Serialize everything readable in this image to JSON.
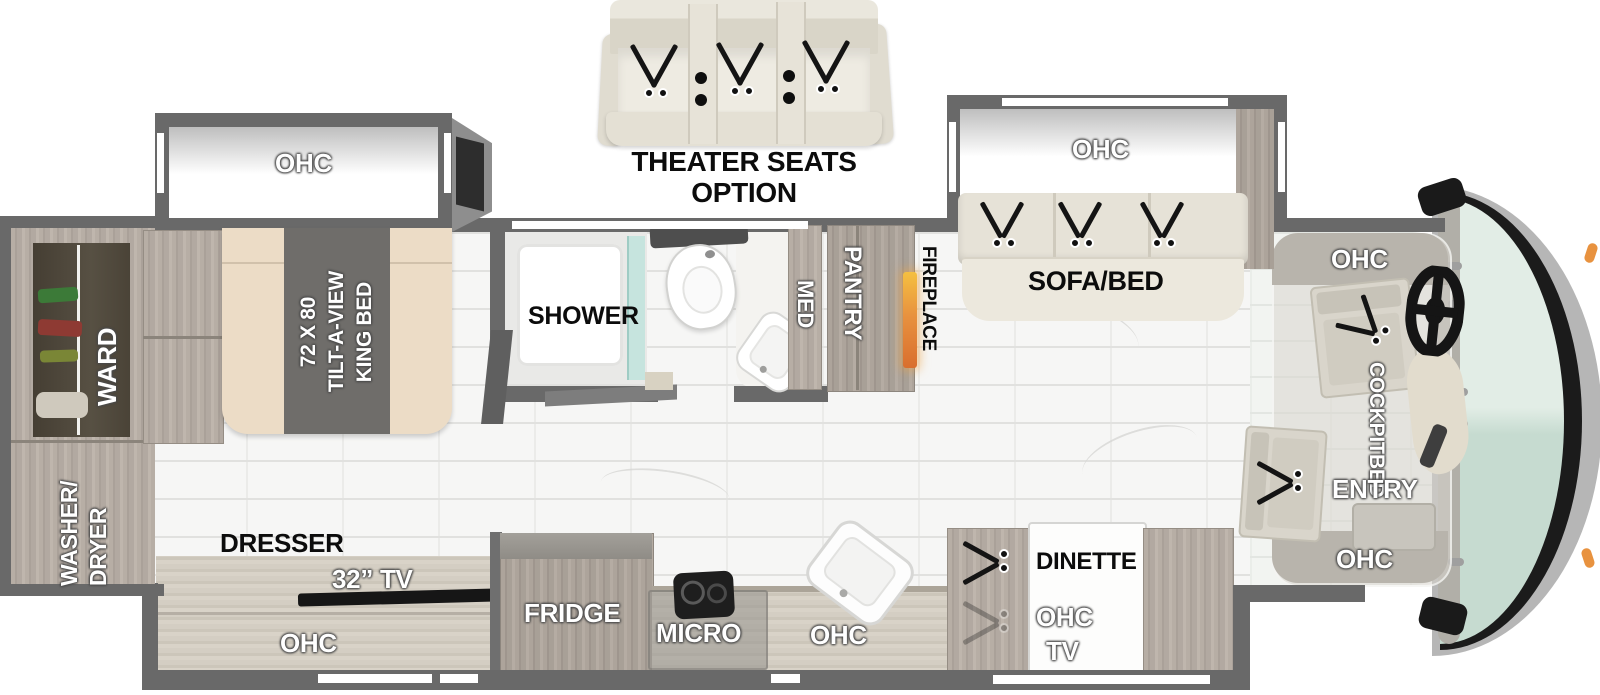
{
  "floorplan": {
    "theater_option": {
      "line1": "THEATER SEATS",
      "line2": "OPTION"
    },
    "bedroom": {
      "ohc": "OHC",
      "bed_size": "72 X 80",
      "bed_type": "TILT-A-VIEW",
      "bed_name": "KING BED",
      "ward": "WARD",
      "washer_line1": "WASHER/",
      "washer_line2": "DRYER",
      "dresser": "DRESSER",
      "tv": "32” TV",
      "dresser_ohc": "OHC"
    },
    "bath": {
      "shower": "SHOWER",
      "med": "MED"
    },
    "galley": {
      "pantry": "PANTRY",
      "fireplace": "FIREPLACE",
      "fridge": "FRIDGE",
      "micro": "MICRO",
      "ohc": "OHC"
    },
    "living": {
      "ohc": "OHC",
      "sofa": "SOFA/BED",
      "dinette": "DINETTE",
      "dinette_ohc": "OHC",
      "dinette_tv": "TV"
    },
    "cockpit": {
      "ohc_top": "OHC",
      "bed_line1": "COCKPIT",
      "bed_line2": "BED",
      "entry": "ENTRY",
      "ohc_bottom": "OHC"
    }
  },
  "colors": {
    "wall": "#696969",
    "wood": "#b2a9a1",
    "counter": "#d4cec3",
    "floor": "#f6f6f5",
    "windshield": "#cfe2d7",
    "clearance_light": "#e8923f",
    "sofa": "#e9e5da",
    "mattress": "#ecdcc6",
    "bed_runner": "#6f6d6a"
  }
}
